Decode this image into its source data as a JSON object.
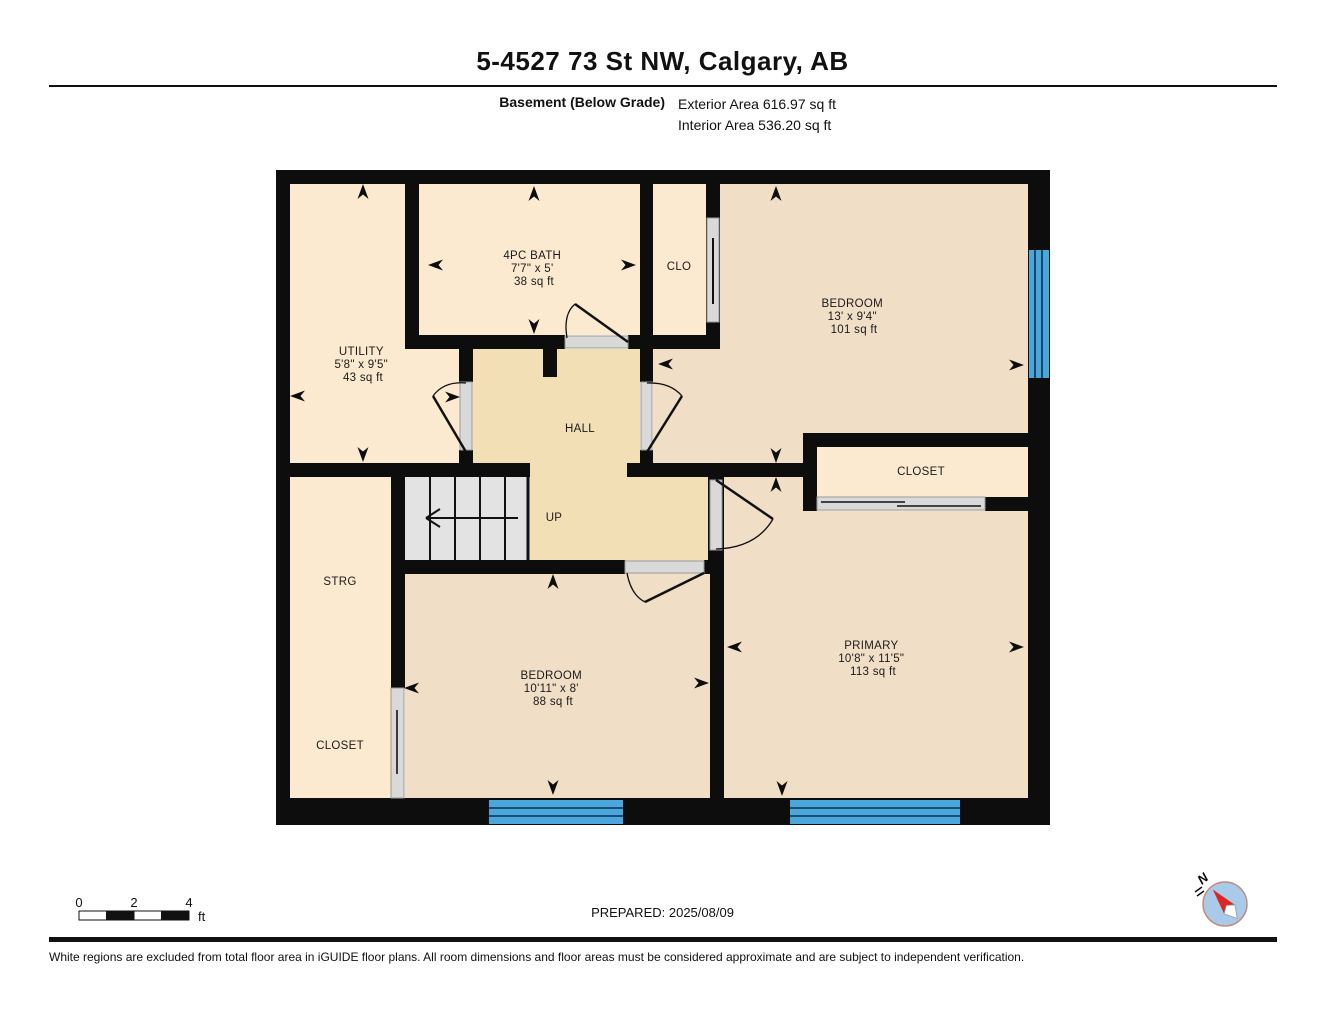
{
  "page": {
    "title": "5-4527 73 St NW, Calgary, AB",
    "floor_label": "Basement (Below Grade)",
    "exterior_area": "Exterior Area 616.97 sq ft",
    "interior_area": "Interior Area 536.20 sq ft",
    "prepared": "PREPARED: 2025/08/09",
    "disclaimer": "White regions are excluded from total floor area in iGUIDE floor plans. All room dimensions and floor areas must be considered approximate and are subject to independent verification."
  },
  "scale_bar": {
    "tick0": "0",
    "tick2": "2",
    "tick4": "4",
    "unit": "ft"
  },
  "compass": {
    "north_label": "N"
  },
  "stairs": {
    "direction_label": "UP"
  },
  "rooms": {
    "utility": {
      "name": "UTILITY",
      "dims": "5'8\" x 9'5\"",
      "area": "43 sq ft"
    },
    "bath": {
      "name": "4PC BATH",
      "dims": "7'7\" x 5'",
      "area": "38 sq ft"
    },
    "clo": {
      "name": "CLO"
    },
    "bedroom_upper": {
      "name": "BEDROOM",
      "dims": "13' x 9'4\"",
      "area": "101 sq ft"
    },
    "hall": {
      "name": "HALL"
    },
    "closet_right": {
      "name": "CLOSET"
    },
    "strg": {
      "name": "STRG"
    },
    "closet_left": {
      "name": "CLOSET"
    },
    "bedroom_lower": {
      "name": "BEDROOM",
      "dims": "10'11\" x 8'",
      "area": "88 sq ft"
    },
    "primary": {
      "name": "PRIMARY",
      "dims": "10'8\" x 11'5\"",
      "area": "113 sq ft"
    }
  },
  "colors": {
    "wall": "#0d0d0d",
    "room_light": "#fcead0",
    "room_medium": "#f0dfc6",
    "hall": "#f3dfb6",
    "stairs": "#e3e3e3",
    "door": "#d9d9d9",
    "window_blue": "#4aa7dc",
    "compass_face": "#a9cbe9",
    "compass_needle": "#e02424"
  }
}
